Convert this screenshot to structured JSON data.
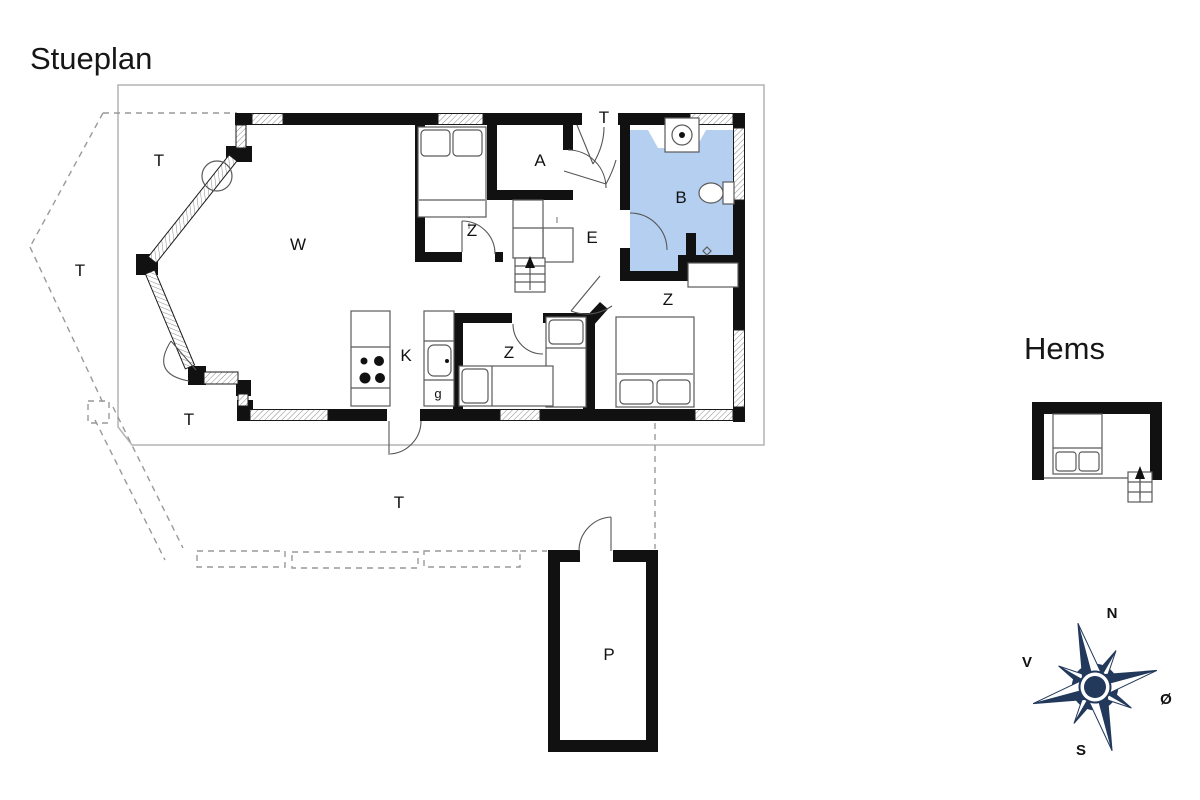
{
  "title": "Stueplan",
  "inset_title": "Hems",
  "labels": {
    "living": "W",
    "bedroom_nw": "Z",
    "bedroom_mid": "Z",
    "bedroom_se": "Z",
    "annex": "A",
    "bathroom": "B",
    "entry": "E",
    "kitchen": "K",
    "pantry": "g",
    "outbuilding": "P",
    "terrace_upper": "T",
    "terrace_left": "T",
    "terrace_lower": "T",
    "terrace_south": "T",
    "terrace_entrance": "T"
  },
  "compass": {
    "north": "N",
    "south": "S",
    "east": "Ø",
    "west": "V"
  },
  "colors": {
    "wall": "#111111",
    "bathroom_fill": "#b5cff0",
    "compass_navy": "#22395c",
    "boundary_gray": "#b3b3b3",
    "dash_gray": "#999999",
    "furniture_gray": "#5a5a5a"
  }
}
